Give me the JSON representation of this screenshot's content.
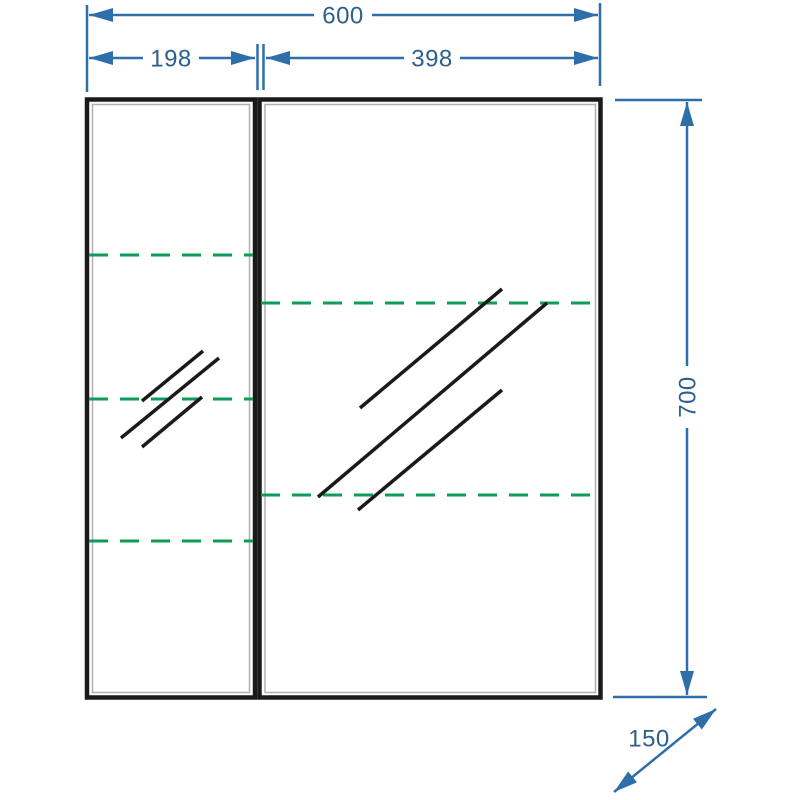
{
  "diagram": {
    "dimensions": {
      "total_width": {
        "label": "600"
      },
      "left_width": {
        "label": "198"
      },
      "right_width": {
        "label": "398"
      },
      "height": {
        "label": "700"
      },
      "depth": {
        "label": "150"
      }
    },
    "colors": {
      "dimension_line_blue": "#2e6fa9",
      "dimension_text_blue": "#2d5f8c",
      "shelf_dash_green": "#0e9c57",
      "outline_black": "#1a1a1a",
      "inner_edge_gray": "#b0b0b0",
      "background": "#ffffff"
    }
  }
}
